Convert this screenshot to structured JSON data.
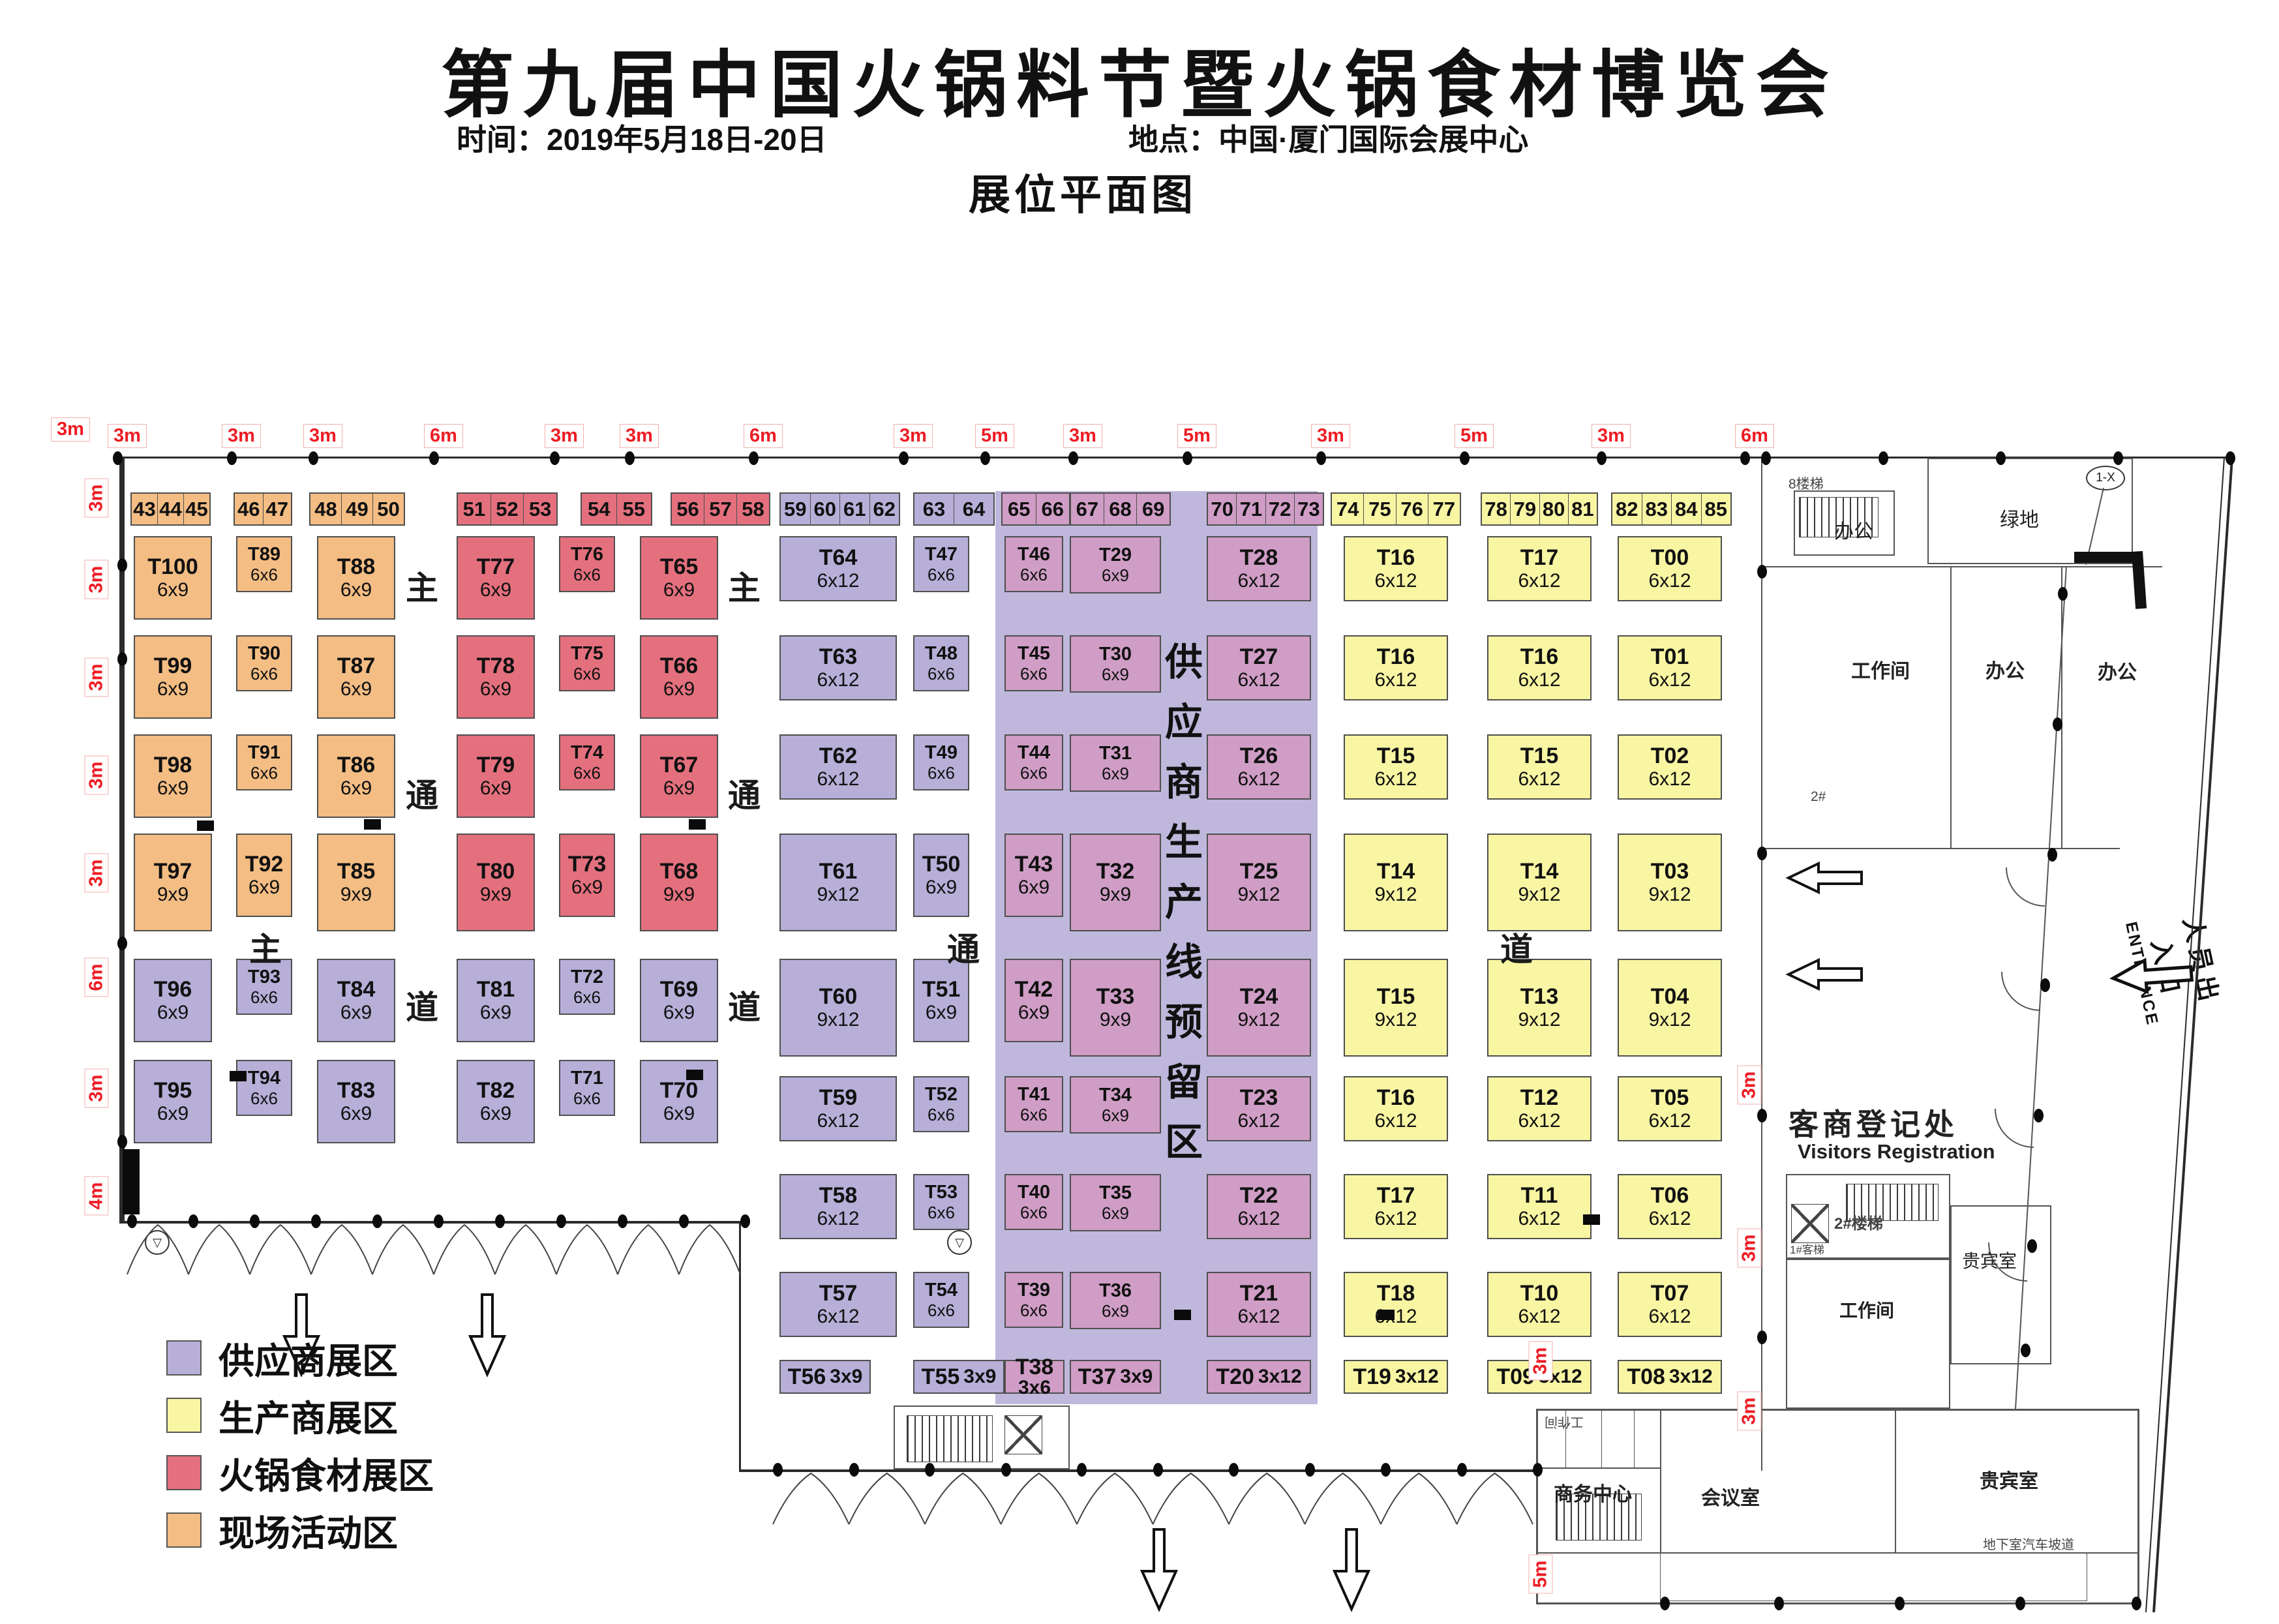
{
  "header": {
    "title": "第九届中国火锅料节暨火锅食材博览会",
    "time": "时间：2019年5月18日-20日",
    "venue": "地点：中国·厦门国际会展中心",
    "plan_title": "展位平面图"
  },
  "legend": [
    {
      "label": "供应商展区",
      "color": "#b7afd8"
    },
    {
      "label": "生产商展区",
      "color": "#f8f6a3"
    },
    {
      "label": "火锅食材展区",
      "color": "#e4707e"
    },
    {
      "label": "现场活动区",
      "color": "#f3bd84"
    }
  ],
  "reserved_band": "供应商生产线预留区",
  "aisle_vertical": [
    "主",
    "通",
    "道"
  ],
  "aisle_horizontal": [
    "主",
    "通",
    "道"
  ],
  "strip_groups": [
    {
      "zone": "o",
      "cells": [
        "43",
        "44",
        "45"
      ]
    },
    {
      "zone": "o",
      "cells": [
        "46",
        "47"
      ]
    },
    {
      "zone": "o",
      "cells": [
        "48",
        "49",
        "50"
      ]
    },
    {
      "zone": "r",
      "cells": [
        "51",
        "52",
        "53"
      ]
    },
    {
      "zone": "r",
      "cells": [
        "54",
        "55"
      ]
    },
    {
      "zone": "r",
      "cells": [
        "56",
        "57",
        "58"
      ]
    },
    {
      "zone": "p",
      "cells": [
        "59",
        "60",
        "61",
        "62"
      ]
    },
    {
      "zone": "p",
      "cells": [
        "63",
        "64"
      ]
    },
    {
      "zone": "m",
      "cells": [
        "65",
        "66"
      ]
    },
    {
      "zone": "m",
      "cells": [
        "67",
        "68",
        "69"
      ]
    },
    {
      "zone": "m",
      "cells": [
        "70",
        "71",
        "72",
        "73"
      ]
    },
    {
      "zone": "y",
      "cells": [
        "74",
        "75",
        "76",
        "77"
      ]
    },
    {
      "zone": "y",
      "cells": [
        "78",
        "79",
        "80",
        "81"
      ]
    },
    {
      "zone": "y",
      "cells": [
        "82",
        "83",
        "84",
        "85"
      ]
    }
  ],
  "booths": [
    {
      "n": "T100",
      "s": "6x9",
      "z": "o",
      "c": 1,
      "r": 1
    },
    {
      "n": "T99",
      "s": "6x9",
      "z": "o",
      "c": 1,
      "r": 2
    },
    {
      "n": "T98",
      "s": "6x9",
      "z": "o",
      "c": 1,
      "r": 3
    },
    {
      "n": "T97",
      "s": "9x9",
      "z": "o",
      "c": 1,
      "r": 4
    },
    {
      "n": "T96",
      "s": "6x9",
      "z": "p",
      "c": 1,
      "r": 5
    },
    {
      "n": "T95",
      "s": "6x9",
      "z": "p",
      "c": 1,
      "r": 6
    },
    {
      "n": "T89",
      "s": "6x6",
      "z": "o",
      "c": 2,
      "r": 1
    },
    {
      "n": "T90",
      "s": "6x6",
      "z": "o",
      "c": 2,
      "r": 2
    },
    {
      "n": "T91",
      "s": "6x6",
      "z": "o",
      "c": 2,
      "r": 3
    },
    {
      "n": "T92",
      "s": "6x9",
      "z": "o",
      "c": 2,
      "r": 4
    },
    {
      "n": "T93",
      "s": "6x6",
      "z": "p",
      "c": 2,
      "r": 5
    },
    {
      "n": "T94",
      "s": "6x6",
      "z": "p",
      "c": 2,
      "r": 6
    },
    {
      "n": "T88",
      "s": "6x9",
      "z": "o",
      "c": 3,
      "r": 1
    },
    {
      "n": "T87",
      "s": "6x9",
      "z": "o",
      "c": 3,
      "r": 2
    },
    {
      "n": "T86",
      "s": "6x9",
      "z": "o",
      "c": 3,
      "r": 3
    },
    {
      "n": "T85",
      "s": "9x9",
      "z": "o",
      "c": 3,
      "r": 4
    },
    {
      "n": "T84",
      "s": "6x9",
      "z": "p",
      "c": 3,
      "r": 5
    },
    {
      "n": "T83",
      "s": "6x9",
      "z": "p",
      "c": 3,
      "r": 6
    },
    {
      "n": "T77",
      "s": "6x9",
      "z": "r",
      "c": 4,
      "r": 1
    },
    {
      "n": "T78",
      "s": "6x9",
      "z": "r",
      "c": 4,
      "r": 2
    },
    {
      "n": "T79",
      "s": "6x9",
      "z": "r",
      "c": 4,
      "r": 3
    },
    {
      "n": "T80",
      "s": "9x9",
      "z": "r",
      "c": 4,
      "r": 4
    },
    {
      "n": "T81",
      "s": "6x9",
      "z": "p",
      "c": 4,
      "r": 5
    },
    {
      "n": "T82",
      "s": "6x9",
      "z": "p",
      "c": 4,
      "r": 6
    },
    {
      "n": "T76",
      "s": "6x6",
      "z": "r",
      "c": 5,
      "r": 1
    },
    {
      "n": "T75",
      "s": "6x6",
      "z": "r",
      "c": 5,
      "r": 2
    },
    {
      "n": "T74",
      "s": "6x6",
      "z": "r",
      "c": 5,
      "r": 3
    },
    {
      "n": "T73",
      "s": "6x9",
      "z": "r",
      "c": 5,
      "r": 4
    },
    {
      "n": "T72",
      "s": "6x6",
      "z": "p",
      "c": 5,
      "r": 5
    },
    {
      "n": "T71",
      "s": "6x6",
      "z": "p",
      "c": 5,
      "r": 6
    },
    {
      "n": "T65",
      "s": "6x9",
      "z": "r",
      "c": 6,
      "r": 1
    },
    {
      "n": "T66",
      "s": "6x9",
      "z": "r",
      "c": 6,
      "r": 2
    },
    {
      "n": "T67",
      "s": "6x9",
      "z": "r",
      "c": 6,
      "r": 3
    },
    {
      "n": "T68",
      "s": "9x9",
      "z": "r",
      "c": 6,
      "r": 4
    },
    {
      "n": "T69",
      "s": "6x9",
      "z": "p",
      "c": 6,
      "r": 5
    },
    {
      "n": "T70",
      "s": "6x9",
      "z": "p",
      "c": 6,
      "r": 6
    },
    {
      "n": "T64",
      "s": "6x12",
      "z": "p",
      "c": 7,
      "r": 1
    },
    {
      "n": "T63",
      "s": "6x12",
      "z": "p",
      "c": 7,
      "r": 2
    },
    {
      "n": "T62",
      "s": "6x12",
      "z": "p",
      "c": 7,
      "r": 3
    },
    {
      "n": "T61",
      "s": "9x12",
      "z": "p",
      "c": 7,
      "r": 4
    },
    {
      "n": "T60",
      "s": "9x12",
      "z": "p",
      "c": 7,
      "r": 5
    },
    {
      "n": "T59",
      "s": "6x12",
      "z": "p",
      "c": 7,
      "r": 6
    },
    {
      "n": "T58",
      "s": "6x12",
      "z": "p",
      "c": 7,
      "r": 7
    },
    {
      "n": "T57",
      "s": "6x12",
      "z": "p",
      "c": 7,
      "r": 8
    },
    {
      "n": "T56",
      "s": "3x9",
      "z": "p",
      "c": 7,
      "r": 9
    },
    {
      "n": "T47",
      "s": "6x6",
      "z": "p",
      "c": 8,
      "r": 1
    },
    {
      "n": "T48",
      "s": "6x6",
      "z": "p",
      "c": 8,
      "r": 2
    },
    {
      "n": "T49",
      "s": "6x6",
      "z": "p",
      "c": 8,
      "r": 3
    },
    {
      "n": "T50",
      "s": "6x9",
      "z": "p",
      "c": 8,
      "r": 4
    },
    {
      "n": "T51",
      "s": "6x9",
      "z": "p",
      "c": 8,
      "r": 5
    },
    {
      "n": "T52",
      "s": "6x6",
      "z": "p",
      "c": 8,
      "r": 6
    },
    {
      "n": "T53",
      "s": "6x6",
      "z": "p",
      "c": 8,
      "r": 7
    },
    {
      "n": "T54",
      "s": "6x6",
      "z": "p",
      "c": 8,
      "r": 8
    },
    {
      "n": "T55",
      "s": "3x9",
      "z": "p",
      "c": 8,
      "r": 9
    },
    {
      "n": "T46",
      "s": "6x6",
      "z": "m",
      "c": 9,
      "r": 1
    },
    {
      "n": "T45",
      "s": "6x6",
      "z": "m",
      "c": 9,
      "r": 2
    },
    {
      "n": "T44",
      "s": "6x6",
      "z": "m",
      "c": 9,
      "r": 3
    },
    {
      "n": "T43",
      "s": "6x9",
      "z": "m",
      "c": 9,
      "r": 4
    },
    {
      "n": "T42",
      "s": "6x9",
      "z": "m",
      "c": 9,
      "r": 5
    },
    {
      "n": "T41",
      "s": "6x6",
      "z": "m",
      "c": 9,
      "r": 6
    },
    {
      "n": "T40",
      "s": "6x6",
      "z": "m",
      "c": 9,
      "r": 7
    },
    {
      "n": "T39",
      "s": "6x6",
      "z": "m",
      "c": 9,
      "r": 8
    },
    {
      "n": "T38",
      "s": "3x6",
      "z": "m",
      "c": 9,
      "r": 9
    },
    {
      "n": "T29",
      "s": "6x9",
      "z": "m",
      "c": 10,
      "r": 1
    },
    {
      "n": "T30",
      "s": "6x9",
      "z": "m",
      "c": 10,
      "r": 2
    },
    {
      "n": "T31",
      "s": "6x9",
      "z": "m",
      "c": 10,
      "r": 3
    },
    {
      "n": "T32",
      "s": "9x9",
      "z": "m",
      "c": 10,
      "r": 4
    },
    {
      "n": "T33",
      "s": "9x9",
      "z": "m",
      "c": 10,
      "r": 5
    },
    {
      "n": "T34",
      "s": "6x9",
      "z": "m",
      "c": 10,
      "r": 6
    },
    {
      "n": "T35",
      "s": "6x9",
      "z": "m",
      "c": 10,
      "r": 7
    },
    {
      "n": "T36",
      "s": "6x9",
      "z": "m",
      "c": 10,
      "r": 8
    },
    {
      "n": "T37",
      "s": "3x9",
      "z": "m",
      "c": 10,
      "r": 9
    },
    {
      "n": "T28",
      "s": "6x12",
      "z": "m",
      "c": 11,
      "r": 1
    },
    {
      "n": "T27",
      "s": "6x12",
      "z": "m",
      "c": 11,
      "r": 2
    },
    {
      "n": "T26",
      "s": "6x12",
      "z": "m",
      "c": 11,
      "r": 3
    },
    {
      "n": "T25",
      "s": "9x12",
      "z": "m",
      "c": 11,
      "r": 4
    },
    {
      "n": "T24",
      "s": "9x12",
      "z": "m",
      "c": 11,
      "r": 5
    },
    {
      "n": "T23",
      "s": "6x12",
      "z": "m",
      "c": 11,
      "r": 6
    },
    {
      "n": "T22",
      "s": "6x12",
      "z": "m",
      "c": 11,
      "r": 7
    },
    {
      "n": "T21",
      "s": "6x12",
      "z": "m",
      "c": 11,
      "r": 8
    },
    {
      "n": "T20",
      "s": "3x12",
      "z": "m",
      "c": 11,
      "r": 9
    },
    {
      "n": "T16",
      "s": "6x12",
      "z": "y",
      "c": 12,
      "r": 1
    },
    {
      "n": "T16",
      "s": "6x12",
      "z": "y",
      "c": 12,
      "r": 2
    },
    {
      "n": "T15",
      "s": "6x12",
      "z": "y",
      "c": 12,
      "r": 3
    },
    {
      "n": "T14",
      "s": "9x12",
      "z": "y",
      "c": 12,
      "r": 4
    },
    {
      "n": "T15",
      "s": "9x12",
      "z": "y",
      "c": 12,
      "r": 5
    },
    {
      "n": "T16",
      "s": "6x12",
      "z": "y",
      "c": 12,
      "r": 6
    },
    {
      "n": "T17",
      "s": "6x12",
      "z": "y",
      "c": 12,
      "r": 7
    },
    {
      "n": "T18",
      "s": "6x12",
      "z": "y",
      "c": 12,
      "r": 8
    },
    {
      "n": "T19",
      "s": "3x12",
      "z": "y",
      "c": 12,
      "r": 9
    },
    {
      "n": "T17",
      "s": "6x12",
      "z": "y",
      "c": 13,
      "r": 1
    },
    {
      "n": "T16",
      "s": "6x12",
      "z": "y",
      "c": 13,
      "r": 2
    },
    {
      "n": "T15",
      "s": "6x12",
      "z": "y",
      "c": 13,
      "r": 3
    },
    {
      "n": "T14",
      "s": "9x12",
      "z": "y",
      "c": 13,
      "r": 4
    },
    {
      "n": "T13",
      "s": "9x12",
      "z": "y",
      "c": 13,
      "r": 5
    },
    {
      "n": "T12",
      "s": "6x12",
      "z": "y",
      "c": 13,
      "r": 6
    },
    {
      "n": "T11",
      "s": "6x12",
      "z": "y",
      "c": 13,
      "r": 7
    },
    {
      "n": "T10",
      "s": "6x12",
      "z": "y",
      "c": 13,
      "r": 8
    },
    {
      "n": "T09",
      "s": "3x12",
      "z": "y",
      "c": 13,
      "r": 9
    },
    {
      "n": "T00",
      "s": "6x12",
      "z": "y",
      "c": 14,
      "r": 1
    },
    {
      "n": "T01",
      "s": "6x12",
      "z": "y",
      "c": 14,
      "r": 2
    },
    {
      "n": "T02",
      "s": "6x12",
      "z": "y",
      "c": 14,
      "r": 3
    },
    {
      "n": "T03",
      "s": "9x12",
      "z": "y",
      "c": 14,
      "r": 4
    },
    {
      "n": "T04",
      "s": "9x12",
      "z": "y",
      "c": 14,
      "r": 5
    },
    {
      "n": "T05",
      "s": "6x12",
      "z": "y",
      "c": 14,
      "r": 6
    },
    {
      "n": "T06",
      "s": "6x12",
      "z": "y",
      "c": 14,
      "r": 7
    },
    {
      "n": "T07",
      "s": "6x12",
      "z": "y",
      "c": 14,
      "r": 8
    },
    {
      "n": "T08",
      "s": "3x12",
      "z": "y",
      "c": 14,
      "r": 9
    }
  ],
  "dims": {
    "corner": "3m",
    "top": [
      "3m",
      "3m",
      "3m",
      "6m",
      "3m",
      "3m",
      "6m",
      "3m",
      "5m",
      "3m",
      "5m",
      "3m",
      "5m",
      "3m",
      "6m"
    ],
    "left": [
      "3m",
      "3m",
      "3m",
      "3m",
      "3m",
      "6m",
      "3m",
      "4m"
    ],
    "right": [
      "3m",
      "3m",
      "3m",
      "3m",
      "5m"
    ]
  },
  "rooms": {
    "louti8": "8楼梯",
    "bangong1": "办公",
    "ludi": "绿地",
    "marker_1x": "1-X",
    "gongzuojian1": "工作间",
    "bangong2": "办公",
    "bangong3": "办公",
    "label_2hash": "2#",
    "reg_cn": "客商登记处",
    "reg_en": "Visitors Registration",
    "louti2": "2#楼梯",
    "keti1": "1#客梯",
    "guibin1": "贵宾室",
    "gongzuojian2": "工作间",
    "louti3": "3#楼梯",
    "gongzuojian3": "工作间",
    "shangwu": "商务中心",
    "huiyi": "会议室",
    "guibin2": "贵宾室",
    "podao": "地下室汽车坡道",
    "vsym": "▽"
  },
  "entrance": {
    "cn": "人员出入口",
    "en": "ENTRANCE"
  }
}
